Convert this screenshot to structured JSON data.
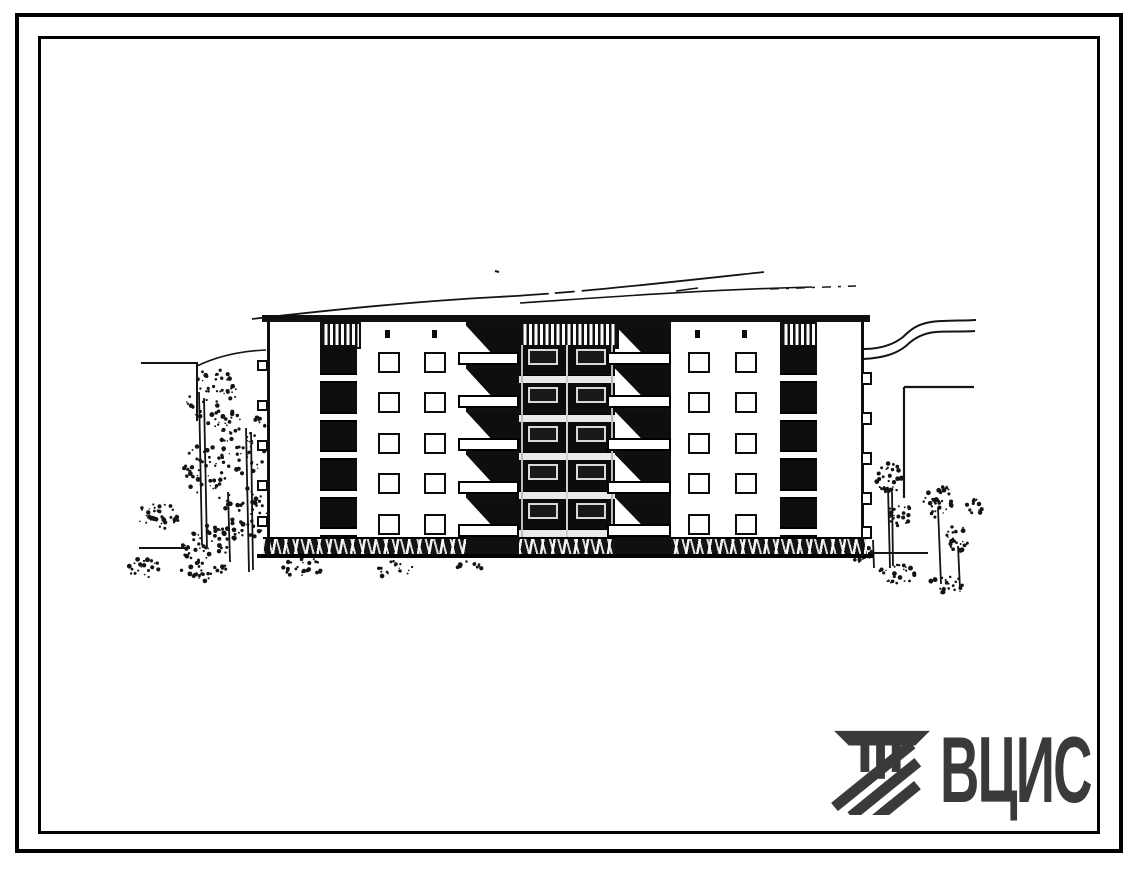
{
  "sheet": {
    "background": "#ffffff",
    "frame_color": "#000000",
    "borders": 2
  },
  "logo": {
    "text": "ВЦИС",
    "color": "#3a3a3c",
    "icon": "vcis-emblem-hatched-icon"
  },
  "drawing": {
    "subject": "five-storey panel apartment building - street elevation sketch",
    "floors": 5,
    "window_sections": [
      {
        "name": "windows-left",
        "rows": 5,
        "cols": 2
      },
      {
        "name": "windows-right",
        "rows": 5,
        "cols": 2
      }
    ],
    "balcony_columns": 4,
    "roof_vents": 6,
    "colors": {
      "ink": "#101010",
      "paper": "#ffffff",
      "slab_fill": "#f7f7f7",
      "window_frame_light": "#d8d8d8"
    }
  }
}
